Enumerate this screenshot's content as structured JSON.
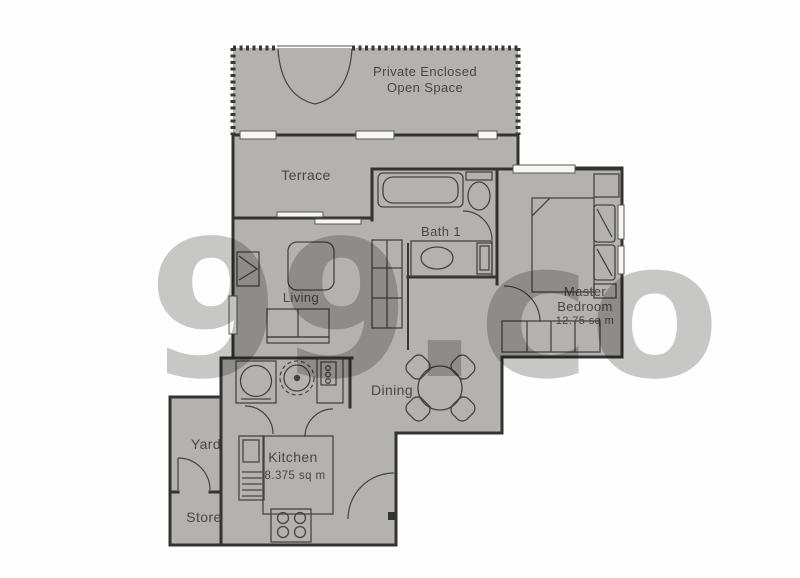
{
  "title": "Apartment floor plan",
  "colors": {
    "floor": "#b4b2af",
    "wall": "#35332f",
    "furniture_line": "#474440",
    "label": "#494641",
    "window": "#f6f6f4",
    "watermark": "#999999"
  },
  "watermark": {
    "text": "99.co"
  },
  "rooms": [
    {
      "name": "Private Enclosed Open Space",
      "label_line1": "Private Enclosed",
      "label_line2": "Open Space"
    },
    {
      "name": "Terrace",
      "label": "Terrace"
    },
    {
      "name": "Bath 1",
      "label": "Bath 1"
    },
    {
      "name": "Living",
      "label": "Living"
    },
    {
      "name": "Master Bedroom",
      "label_line1": "Master",
      "label_line2": "Bedroom",
      "area": "12.75 sq m"
    },
    {
      "name": "Dining",
      "label": "Dining"
    },
    {
      "name": "Yard",
      "label": "Yard"
    },
    {
      "name": "Kitchen",
      "label": "Kitchen",
      "area": "8.375 sq m"
    },
    {
      "name": "Store",
      "label": "Store"
    }
  ]
}
